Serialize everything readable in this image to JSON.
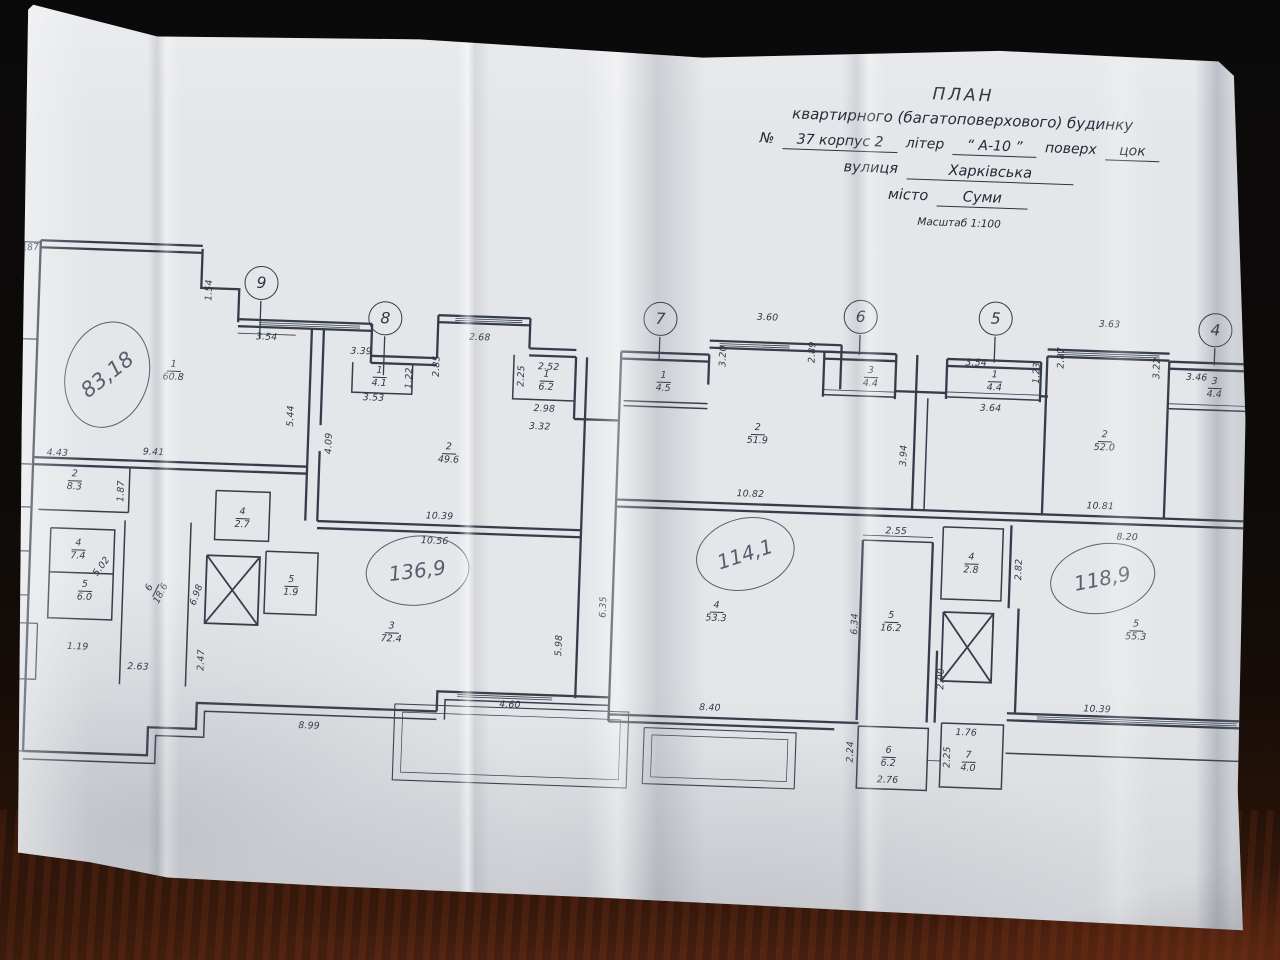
{
  "colors": {
    "ink": "#353d4b",
    "text": "#2f3743",
    "pen": "#565f6e",
    "paper": "#e4e6e9",
    "table_dark": "#0c0a09",
    "wood_red": "#3a1d0e"
  },
  "title_block": {
    "line1": "ПЛАН",
    "line2": "квартирного (багатоповерхового) будинку",
    "no_label": "№",
    "no_value": "37 корпус 2",
    "liter_label": "літер",
    "liter_value": "“ А-10 ”",
    "floor_label": "поверх",
    "floor_value": "цок",
    "street_label": "вулиця",
    "street_value": "Харківська",
    "city_label": "місто",
    "city_value": "Суми",
    "scale": "Масштаб 1:100"
  },
  "plan": {
    "axes": [
      {
        "n": "9",
        "u": 250,
        "v": 246
      },
      {
        "n": "8",
        "u": 375,
        "v": 277
      },
      {
        "n": "7",
        "u": 650,
        "v": 268
      },
      {
        "n": "6",
        "u": 850,
        "v": 259
      },
      {
        "n": "5",
        "u": 985,
        "v": 256
      },
      {
        "n": "4",
        "u": 1205,
        "v": 260
      }
    ],
    "rooms": [
      {
        "num": "1",
        "area": "60.8",
        "u": 165,
        "v": 334,
        "rot": 0
      },
      {
        "num": "2",
        "area": "8.3",
        "u": 70,
        "v": 447,
        "rot": 0
      },
      {
        "num": "4",
        "area": "7.4",
        "u": 76,
        "v": 516,
        "rot": 0
      },
      {
        "num": "5",
        "area": "6.0",
        "u": 84,
        "v": 557,
        "rot": 0
      },
      {
        "num": "6",
        "area": "18.6",
        "u": 152,
        "v": 556,
        "rot": -65
      },
      {
        "num": "4",
        "area": "2.7",
        "u": 239,
        "v": 479,
        "rot": 0
      },
      {
        "num": "5",
        "area": "1.9",
        "u": 290,
        "v": 545,
        "rot": 0
      },
      {
        "num": "1",
        "area": "4.1",
        "u": 371,
        "v": 333,
        "rot": 0
      },
      {
        "num": "2",
        "area": "49.6",
        "u": 443,
        "v": 407,
        "rot": 0
      },
      {
        "num": "1",
        "area": "6.2",
        "u": 538,
        "v": 331,
        "rot": 0
      },
      {
        "num": "3",
        "area": "72.4",
        "u": 392,
        "v": 588,
        "rot": 0
      },
      {
        "num": "1",
        "area": "4.5",
        "u": 655,
        "v": 328,
        "rot": 0
      },
      {
        "num": "2",
        "area": "51.9",
        "u": 751,
        "v": 377,
        "rot": 0
      },
      {
        "num": "4",
        "area": "53.3",
        "u": 716,
        "v": 556,
        "rot": 0
      },
      {
        "num": "3",
        "area": "4.4",
        "u": 862,
        "v": 316,
        "rot": 0
      },
      {
        "num": "1",
        "area": "4.4",
        "u": 986,
        "v": 316,
        "rot": 0
      },
      {
        "num": "2",
        "area": "52.0",
        "u": 1098,
        "v": 372,
        "rot": 0
      },
      {
        "num": "4",
        "area": "2.8",
        "u": 969,
        "v": 499,
        "rot": 0
      },
      {
        "num": "5",
        "area": "16.2",
        "u": 891,
        "v": 560,
        "rot": 0
      },
      {
        "num": "5",
        "area": "55.3",
        "u": 1136,
        "v": 560,
        "rot": 0
      },
      {
        "num": "6",
        "area": "6.2",
        "u": 893,
        "v": 695,
        "rot": 0
      },
      {
        "num": "7",
        "area": "4.0",
        "u": 973,
        "v": 697,
        "rot": 0
      },
      {
        "num": "3",
        "area": "4.4",
        "u": 1206,
        "v": 315,
        "rot": 0
      }
    ],
    "dims": [
      {
        "t": "3.87",
        "u": 16,
        "v": 219,
        "rot": -6
      },
      {
        "t": "1.54",
        "u": 198,
        "v": 255,
        "rot": -90
      },
      {
        "t": "3.54",
        "u": 257,
        "v": 300,
        "rot": 0
      },
      {
        "t": "3.39",
        "u": 352,
        "v": 311,
        "rot": 0
      },
      {
        "t": "3.53",
        "u": 366,
        "v": 357,
        "rot": 0
      },
      {
        "t": "1.22",
        "u": 401,
        "v": 336,
        "rot": -90
      },
      {
        "t": "2.85",
        "u": 428,
        "v": 323,
        "rot": -90
      },
      {
        "t": "2.68",
        "u": 470,
        "v": 293,
        "rot": 0
      },
      {
        "t": "2.52",
        "u": 540,
        "v": 320,
        "rot": 0
      },
      {
        "t": "2.25",
        "u": 513,
        "v": 330,
        "rot": -90
      },
      {
        "t": "2.98",
        "u": 537,
        "v": 362,
        "rot": 0
      },
      {
        "t": "3.32",
        "u": 533,
        "v": 380,
        "rot": 0
      },
      {
        "t": "5.44",
        "u": 284,
        "v": 378,
        "rot": -90
      },
      {
        "t": "4.09",
        "u": 323,
        "v": 404,
        "rot": -90
      },
      {
        "t": "9.41",
        "u": 148,
        "v": 419,
        "rot": 0
      },
      {
        "t": "4.43",
        "u": 52,
        "v": 423,
        "rot": 0
      },
      {
        "t": "1.87",
        "u": 117,
        "v": 459,
        "rot": -90
      },
      {
        "t": "5.02",
        "u": 100,
        "v": 535,
        "rot": -55
      },
      {
        "t": "6.98",
        "u": 196,
        "v": 560,
        "rot": -72
      },
      {
        "t": "1.19",
        "u": 79,
        "v": 616,
        "rot": 0
      },
      {
        "t": "2.63",
        "u": 140,
        "v": 634,
        "rot": 0
      },
      {
        "t": "2.47",
        "u": 203,
        "v": 625,
        "rot": -90
      },
      {
        "t": "10.39",
        "u": 436,
        "v": 473,
        "rot": 0
      },
      {
        "t": "10.56",
        "u": 432,
        "v": 498,
        "rot": 0
      },
      {
        "t": "8.99",
        "u": 313,
        "v": 687,
        "rot": 0
      },
      {
        "t": "4.60",
        "u": 513,
        "v": 659,
        "rot": 0
      },
      {
        "t": "5.98",
        "u": 560,
        "v": 598,
        "rot": -90
      },
      {
        "t": "6.35",
        "u": 603,
        "v": 558,
        "rot": -90
      },
      {
        "t": "3.60",
        "u": 757,
        "v": 263,
        "rot": 0
      },
      {
        "t": "3.20",
        "u": 714,
        "v": 303,
        "rot": -90
      },
      {
        "t": "2.89",
        "u": 803,
        "v": 296,
        "rot": -90
      },
      {
        "t": "10.82",
        "u": 746,
        "v": 440,
        "rot": 0
      },
      {
        "t": "3.94",
        "u": 898,
        "v": 396,
        "rot": -90
      },
      {
        "t": "8.40",
        "u": 713,
        "v": 655,
        "rot": 0
      },
      {
        "t": "3.54",
        "u": 967,
        "v": 301,
        "rot": 0
      },
      {
        "t": "3.64",
        "u": 983,
        "v": 346,
        "rot": 0
      },
      {
        "t": "1.23",
        "u": 1028,
        "v": 309,
        "rot": -90
      },
      {
        "t": "2.87",
        "u": 1052,
        "v": 293,
        "rot": -90
      },
      {
        "t": "3.63",
        "u": 1099,
        "v": 258,
        "rot": 0
      },
      {
        "t": "3.22",
        "u": 1148,
        "v": 300,
        "rot": -90
      },
      {
        "t": "3.46",
        "u": 1188,
        "v": 308,
        "rot": 0
      },
      {
        "t": "1.26",
        "u": 1258,
        "v": 315,
        "rot": -90
      },
      {
        "t": "3.63",
        "u": 1258,
        "v": 398,
        "rot": -90
      },
      {
        "t": "10.81",
        "u": 1096,
        "v": 440,
        "rot": 0
      },
      {
        "t": "2.55",
        "u": 893,
        "v": 472,
        "rot": 0
      },
      {
        "t": "2.82",
        "u": 1017,
        "v": 506,
        "rot": -90
      },
      {
        "t": "6.34",
        "u": 855,
        "v": 566,
        "rot": -90
      },
      {
        "t": "8.20",
        "u": 1124,
        "v": 470,
        "rot": 0
      },
      {
        "t": "6.36",
        "u": 1247,
        "v": 566,
        "rot": -90
      },
      {
        "t": "2.00",
        "u": 943,
        "v": 618,
        "rot": -90
      },
      {
        "t": "2.24",
        "u": 855,
        "v": 694,
        "rot": -90
      },
      {
        "t": "2.76",
        "u": 893,
        "v": 721,
        "rot": 0
      },
      {
        "t": "1.76",
        "u": 970,
        "v": 671,
        "rot": 0
      },
      {
        "t": "2.25",
        "u": 952,
        "v": 696,
        "rot": -90
      },
      {
        "t": "10.39",
        "u": 1100,
        "v": 643,
        "rot": 0
      }
    ],
    "handwritten": [
      {
        "t": "83,18",
        "u": 99,
        "v": 343,
        "rx": 42,
        "ry": 54,
        "erot": 14,
        "rot": -40,
        "fs": 21
      },
      {
        "t": "136,9",
        "u": 416,
        "v": 528,
        "rx": 52,
        "ry": 35,
        "erot": -8,
        "rot": -9,
        "fs": 20
      },
      {
        "t": "114,1",
        "u": 743,
        "v": 500,
        "rx": 50,
        "ry": 36,
        "erot": -16,
        "rot": -20,
        "fs": 20
      },
      {
        "t": "118,9",
        "u": 1101,
        "v": 512,
        "rx": 53,
        "ry": 35,
        "erot": -12,
        "rot": -13,
        "fs": 20
      }
    ]
  }
}
